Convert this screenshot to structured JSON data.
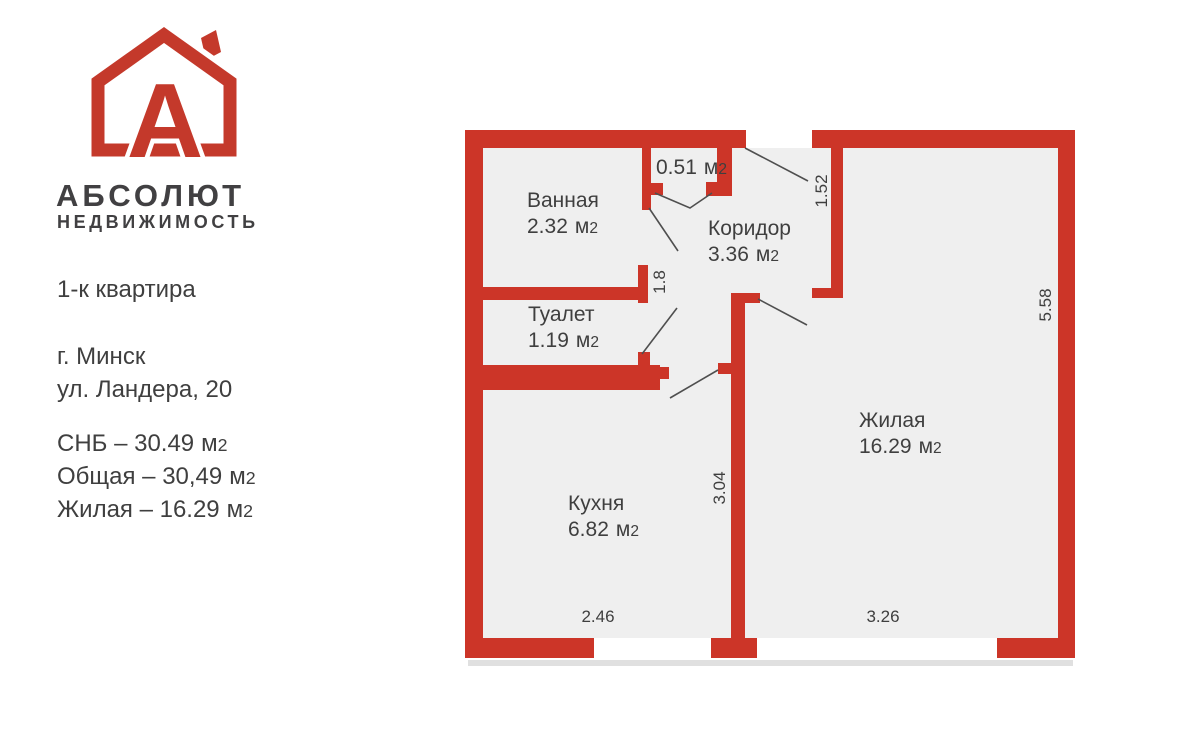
{
  "colors": {
    "brand_red": "#c4392b",
    "wall_red": "#cc3528",
    "floor": "#efefef",
    "line": "#4f4f4f",
    "text_dark": "#3f3f3f",
    "heading": "#414042",
    "shadow": "#e0e0e0"
  },
  "brand": {
    "logo_letter": "А",
    "title": "АБСОЛЮТ",
    "subtitle": "НЕДВИЖИМОСТЬ"
  },
  "listing": {
    "type": "1-к квартира",
    "city": "г. Минск",
    "street": "ул. Ландера, 20",
    "info_lines": [
      {
        "text": "СНБ – 30.49"
      },
      {
        "text": "Общая – 30,49"
      },
      {
        "text": "Жилая – 16.29"
      }
    ]
  },
  "units": {
    "base": "м",
    "sup": "2"
  },
  "plan": {
    "rooms": [
      {
        "name": "Ванная",
        "area": "2.32"
      },
      {
        "name": "Туалет",
        "area": "1.19"
      },
      {
        "name": "Коридор",
        "area": "3.36"
      },
      {
        "name": "Кухня",
        "area": "6.82"
      },
      {
        "name": "Жилая",
        "area": "16.29"
      },
      {
        "name": "",
        "area": "0.51"
      }
    ],
    "dimensions": [
      {
        "value": "1.52"
      },
      {
        "value": "1.8"
      },
      {
        "value": "5.58"
      },
      {
        "value": "3.04"
      },
      {
        "value": "2.46"
      },
      {
        "value": "3.26"
      }
    ]
  }
}
